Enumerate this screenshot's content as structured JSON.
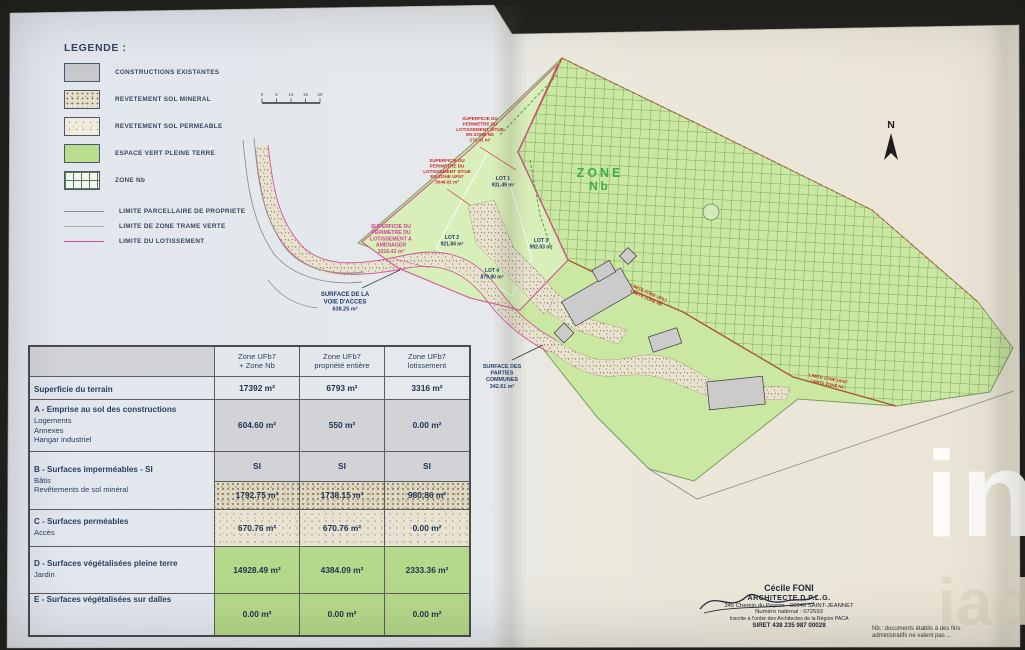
{
  "legend": {
    "title": "LEGENDE :",
    "swatches": [
      {
        "label": "CONSTRUCTIONS EXISTANTES"
      },
      {
        "label": "REVETEMENT SOL MINERAL"
      },
      {
        "label": "REVETEMENT SOL PERMEABLE"
      },
      {
        "label": "ESPACE VERT PLEINE TERRE"
      },
      {
        "label": "ZONE Nb"
      }
    ],
    "lines": [
      {
        "label": "LIMITE PARCELLAIRE DE PROPRIETE"
      },
      {
        "label": "LIMITE DE ZONE TRAME VERTE"
      },
      {
        "label": "LIMITE DU LOTISSEMENT"
      }
    ]
  },
  "scalebar": {
    "ticks": [
      "0",
      "5",
      "10",
      "15",
      "20"
    ]
  },
  "compass": {
    "label": "N"
  },
  "map": {
    "zone_label_line1": "ZONE",
    "zone_label_line2": "Nb",
    "lots": [
      {
        "name": "LOT 1",
        "area": "931.49 m²"
      },
      {
        "name": "LOT 2",
        "area": "921.84 m²"
      },
      {
        "name": "LOT 3",
        "area": "992.03 m²"
      },
      {
        "name": "LOT 4",
        "area": "879.80 m²"
      }
    ],
    "voie": {
      "l1": "SURFACE DE LA",
      "l2": "VOIE D'ACCES",
      "l3": "638.25 m²"
    },
    "communes": {
      "l1": "SURFACE DES",
      "l2": "PARTIES",
      "l3": "COMMUNES",
      "l4": "342.61 m²"
    },
    "red_nb": {
      "l1": "SUPERFICIE DU",
      "l2": "PERIMETRE DU",
      "l3": "LOTISSEMENT SITUE",
      "l4": "EN ZONE Nb",
      "l5": "270.41 m²"
    },
    "red_ufb7": {
      "l1": "SUPERFICIE DU",
      "l2": "PERIMETRE DU",
      "l3": "LOTISSEMENT SITUE",
      "l4": "EN ZONE UFb7",
      "l5": "3046.01 m²"
    },
    "red_amenager": {
      "l1": "SUPERFICIE DU",
      "l2": "PERIMETRE DU",
      "l3": "LOTISSEMENT A",
      "l4": "AMENAGER",
      "l5": "3316.42 m²"
    },
    "limit_label_1": "LIMITE ZONE UFb7",
    "limit_label_2": "LIMITE ZONE Nb"
  },
  "table": {
    "headers": [
      {
        "line1": "Zone UFb7",
        "line2": "+ Zone Nb"
      },
      {
        "line1": "Zone UFb7",
        "line2": "propriété entière"
      },
      {
        "line1": "Zone UFb7",
        "line2": "lotissement"
      }
    ],
    "rows": [
      {
        "title": "Superficie du terrain",
        "sub": "",
        "v": [
          "17392 m²",
          "6793 m²",
          "3316 m²"
        ]
      },
      {
        "title": "A - Emprise au sol des constructions",
        "sub": "Logements\nAnnexes\nHangar industriel",
        "v": [
          "604.60 m²",
          "550 m²",
          "0.00 m²"
        ]
      },
      {
        "title": "B - Surfaces imperméables - SI",
        "sub": "",
        "v": [
          "SI",
          "SI",
          "SI"
        ]
      },
      {
        "title": "",
        "sub": "Bâtis\nRevêtements de sol minéral",
        "v": [
          "1792.75 m²",
          "1738.15 m²",
          "980.86 m²"
        ]
      },
      {
        "title": "C - Surfaces perméables",
        "sub": "Accès",
        "v": [
          "670.76 m²",
          "670.76 m²",
          "0.00 m²"
        ]
      },
      {
        "title": "D - Surfaces végétalisées pleine terre",
        "sub": "Jardin",
        "v": [
          "14928.49 m²",
          "4384.09 m²",
          "2333.36 m²"
        ]
      },
      {
        "title": "E - Surfaces végétalisées sur dalles",
        "sub": "",
        "v": [
          "0.00 m²",
          "0.00 m²",
          "0.00 m²"
        ]
      }
    ]
  },
  "architect": {
    "name": "Cécile FONI",
    "title": "ARCHITECTE D.P.L.G.",
    "address": "345 Chemin du Peyron - 06640 SAINT-JEANNET",
    "national_number": "Numéro national : 072593",
    "order": "Inscrite à l'ordre des Architectes de la Région PACA",
    "siret": "SIRET 438 235 987 00028"
  },
  "note": {
    "line1": "Nb.: documents établis à des fins",
    "line2": "administratifs ne valent pas ..."
  },
  "watermark": {
    "line1": "in",
    "line2": "iad"
  },
  "colors": {
    "espace_vert": "#cbe8a2",
    "zone_nb_grid": "#4f7f44",
    "limite_lotissement": "#d0559a",
    "limite_zone": "#a85a2e",
    "zone_label_green": "#3dae4c",
    "navy_text": "#2a3c5e"
  }
}
